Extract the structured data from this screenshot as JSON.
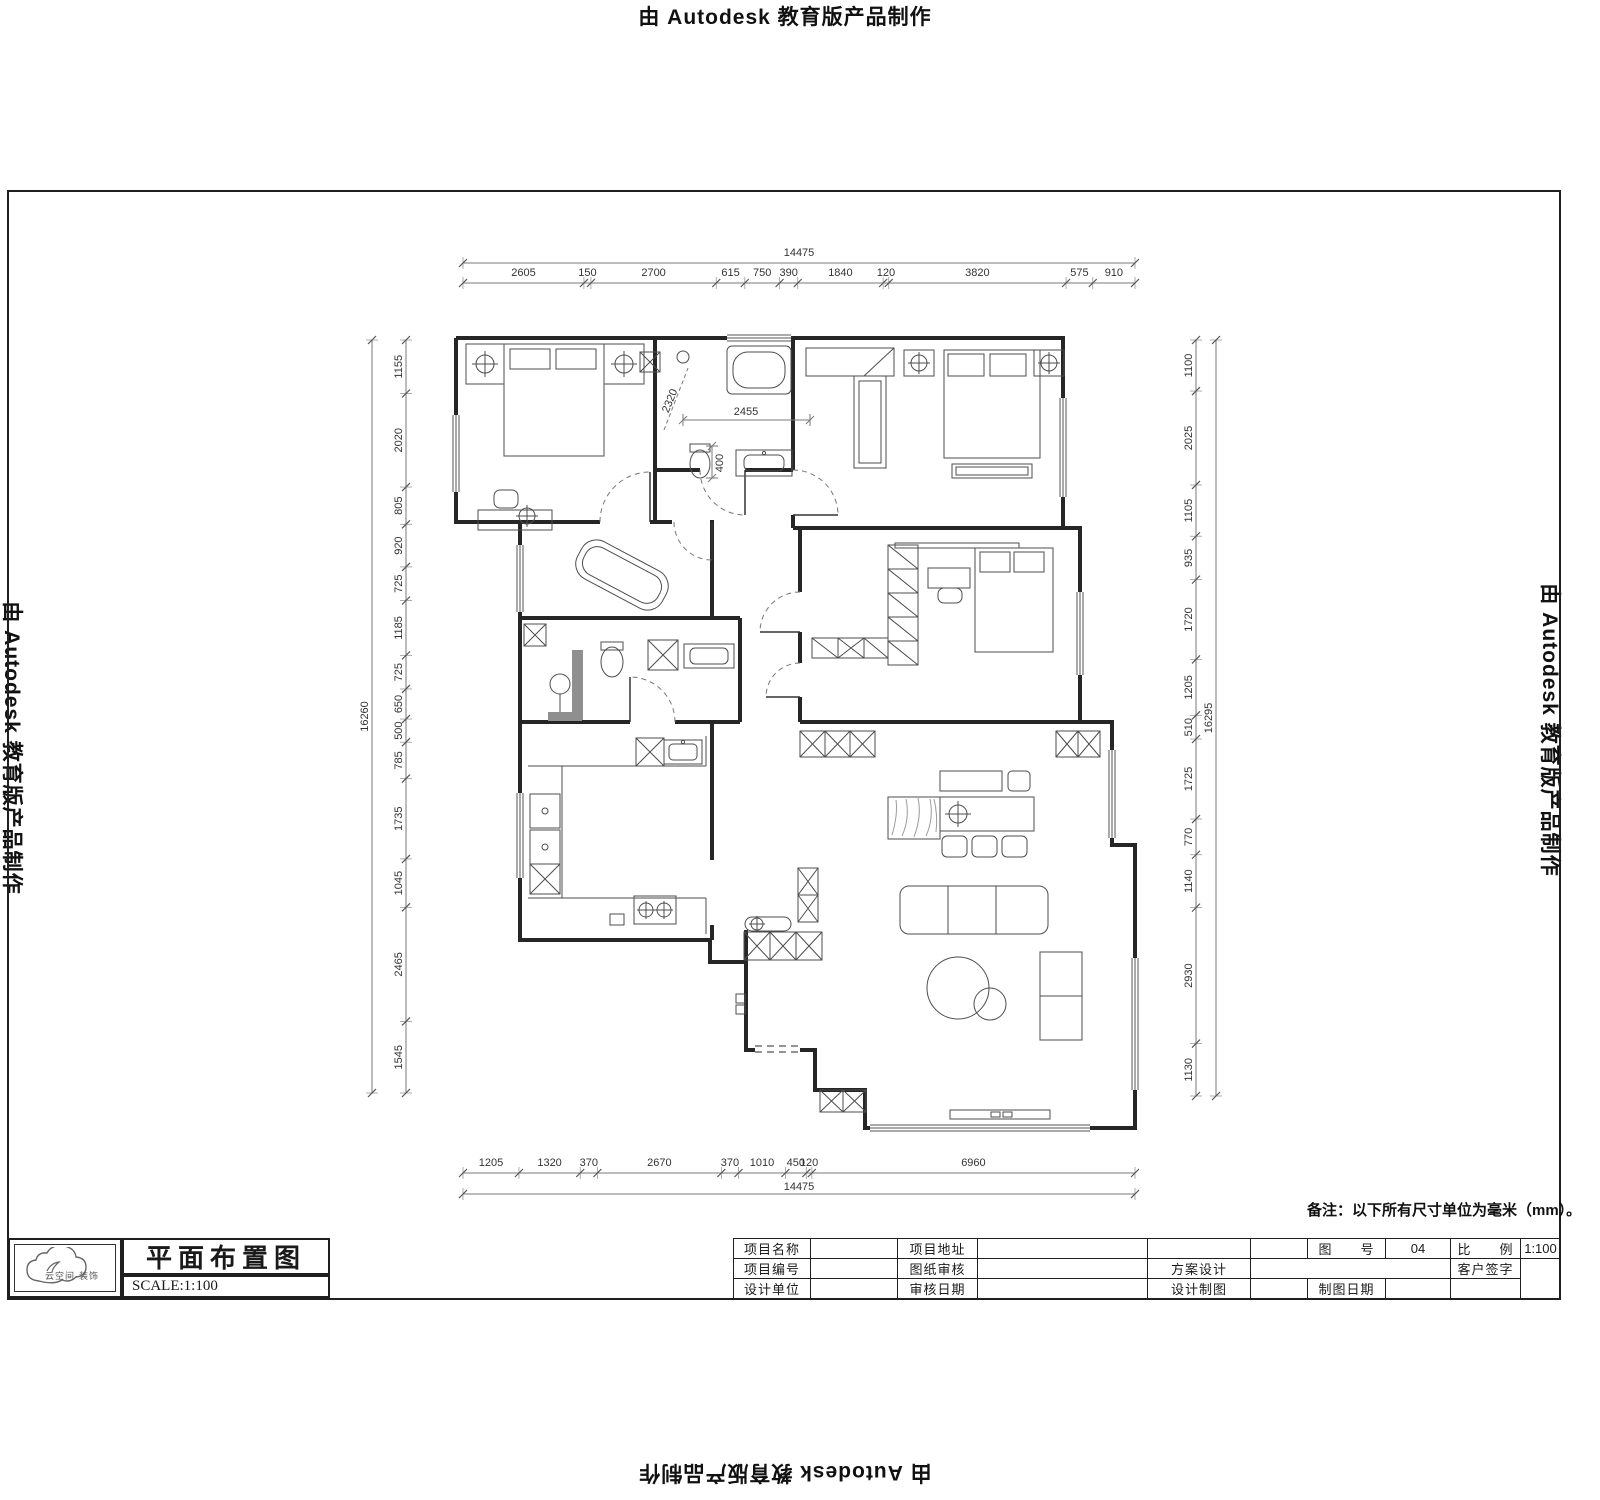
{
  "stamps": {
    "top": "由 Autodesk 教育版产品制作",
    "left": "由 Autodesk 教育版产品制作",
    "right": "由 Autodesk 教育版产品制作",
    "bottom": "由 Autodesk 教育版产品制作"
  },
  "note": {
    "text": "备注：以下所有尺寸单位为毫米（mm）。"
  },
  "title_block": {
    "logo_text": "云空间·装饰",
    "title": "平面布置图",
    "scale": "SCALE:1:100",
    "table": {
      "project_name": "项目名称",
      "project_addr": "项目地址",
      "fig_no_label": "图　　号",
      "fig_no": "04",
      "ratio_label": "比　　例",
      "ratio_val": "1:100",
      "project_id": "项目编号",
      "sheet_review": "图纸审核",
      "scheme_design": "方案设计",
      "client_sign": "客户签字",
      "design_unit": "设计单位",
      "review_date": "审核日期",
      "design_draft": "设计制图",
      "draft_date": "制图日期"
    }
  },
  "plan": {
    "dims": {
      "top": {
        "total": "14475",
        "segments": [
          "2605",
          "150",
          "2700",
          "615",
          "750",
          "390",
          "1840",
          "120",
          "3820",
          "575",
          "910"
        ]
      },
      "bottom": {
        "total": "14475",
        "segments": [
          "1205",
          "1320",
          "370",
          "2670",
          "370",
          "1010",
          "450",
          "120",
          "6960"
        ]
      },
      "left": {
        "total": "16260",
        "segments": [
          "1155",
          "2020",
          "805",
          "920",
          "725",
          "1185",
          "725",
          "650",
          "500",
          "785",
          "1735",
          "1045",
          "2465",
          "1545"
        ]
      },
      "right": {
        "total": "16295",
        "segments": [
          "1100",
          "2025",
          "1105",
          "935",
          "1720",
          "1205",
          "510",
          "1725",
          "770",
          "1140",
          "2930",
          "1130"
        ]
      },
      "interior": {
        "bath_depth": "2320",
        "hall_width": "2455",
        "toilet_clear": "400"
      }
    }
  }
}
